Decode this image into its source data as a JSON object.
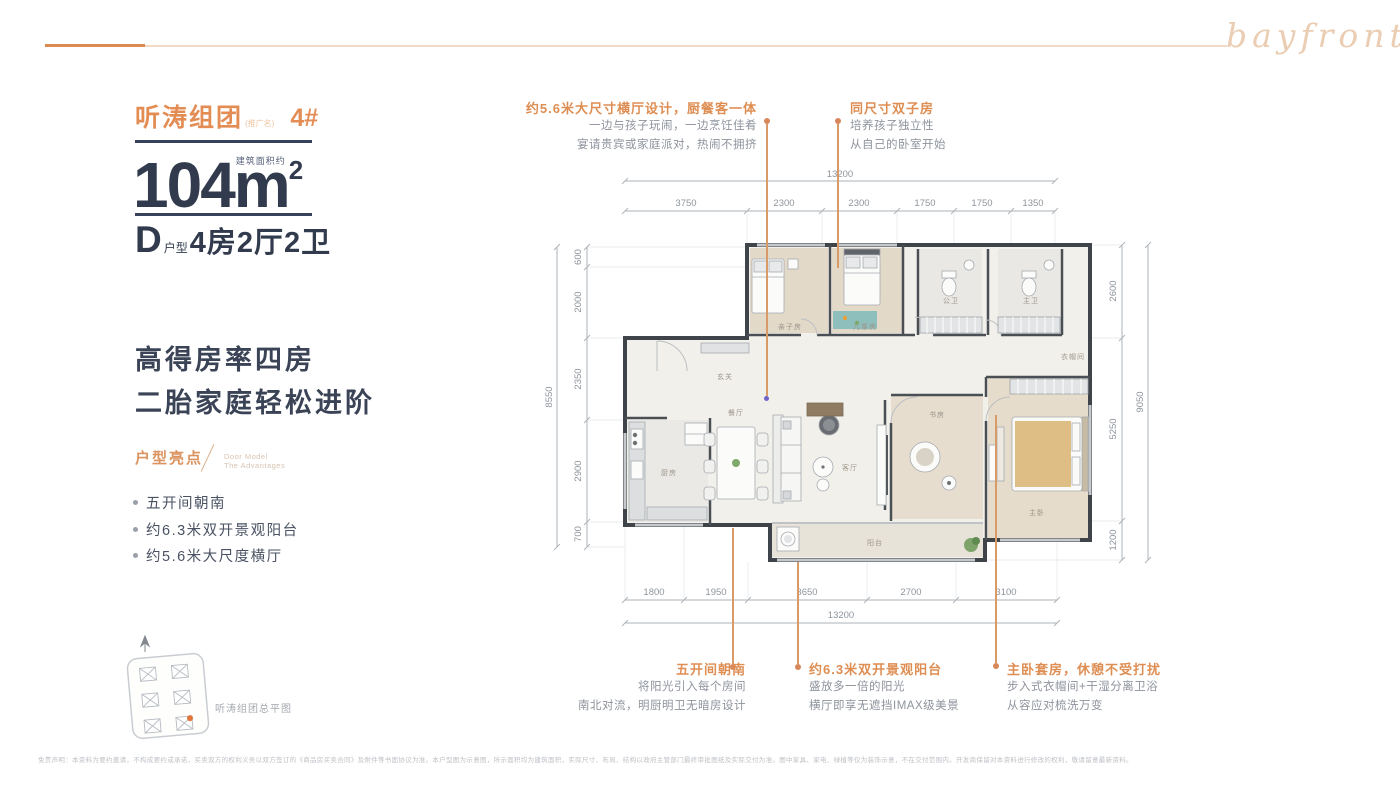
{
  "header": {
    "script_logo": "bayfront"
  },
  "left_panel": {
    "group_name": "听涛组团",
    "group_tag": "(推广名)",
    "building_no": "4#",
    "area": {
      "prefix": "建筑面积约",
      "value": "104",
      "unit": "m",
      "sup": "2"
    },
    "unit": {
      "letter": "D",
      "label": "户型",
      "spec": "4房2厅2卫"
    },
    "headline1": "高得房率四房",
    "headline2": "二胎家庭轻松进阶",
    "highlights": {
      "title": "户型亮点",
      "en1": "Door Model",
      "en2": "The Advantages",
      "items": [
        "五开间朝南",
        "约6.3米双开景观阳台",
        "约5.6米大尺度横厅"
      ]
    },
    "siteplan_caption": "听涛组团总平图"
  },
  "annotations": {
    "top1": {
      "title": "约5.6米大尺寸横厅设计，厨餐客一体",
      "line1": "一边与孩子玩闹，一边烹饪佳肴",
      "line2": "宴请贵宾或家庭派对，热闹不拥挤"
    },
    "top2": {
      "title": "同尺寸双子房",
      "line1": "培养孩子独立性",
      "line2": "从自己的卧室开始"
    },
    "bottom1": {
      "title": "五开间朝南",
      "line1": "将阳光引入每个房间",
      "line2": "南北对流，明厨明卫无暗房设计"
    },
    "bottom2": {
      "title": "约6.3米双开景观阳台",
      "line1": "盛放多一倍的阳光",
      "line2": "横厅即享无遮挡IMAX级美景"
    },
    "bottom3": {
      "title": "主卧套房，休憩不受打扰",
      "line1": "步入式衣帽间+干湿分离卫浴",
      "line2": "从容应对梳洗万变"
    }
  },
  "plan": {
    "dims": {
      "top": {
        "total": "13200",
        "segments": [
          "3750",
          "2300",
          "2300",
          "1750",
          "1750",
          "1350"
        ]
      },
      "bottom": {
        "total": "13200",
        "segments": [
          "1800",
          "1950",
          "3650",
          "2700",
          "3100"
        ]
      },
      "left": {
        "total": "8550",
        "segments": [
          "600",
          "2000",
          "2350",
          "2900",
          "700"
        ]
      },
      "right": {
        "total": "9050",
        "segments": [
          "2600",
          "5250",
          "1200"
        ]
      }
    },
    "rooms": {
      "kitchen": "厨房",
      "dining": "餐厅",
      "living": "客厅",
      "entry": "玄关",
      "balcony": "阳台",
      "twin_a": "亲子房",
      "twin_b": "儿童房",
      "bath_guest": "公卫",
      "bath_master": "主卫",
      "study": "书房",
      "master": "主卧",
      "closet": "衣帽间"
    }
  },
  "footer": {
    "disclaimer": "免责声明：本资料为要约邀请，不构成要约或承诺，买卖双方的权利义务以双方签订的《商品房买卖合同》及附件等书面协议为准。本户型图为示意图，所示面积均为建筑面积，实际尺寸、布局、结构以政府主管部门最终审批图纸及实际交付为准。图中家具、家电、绿植等仅为装饰示意，不在交付范围内。开发商保留对本资料进行修改的权利，敬请留意最新资料。"
  },
  "colors": {
    "accent": "#DE8E53",
    "dark_navy": "#333C50",
    "text_gray": "#8E939C",
    "wall": "#3F444A"
  }
}
